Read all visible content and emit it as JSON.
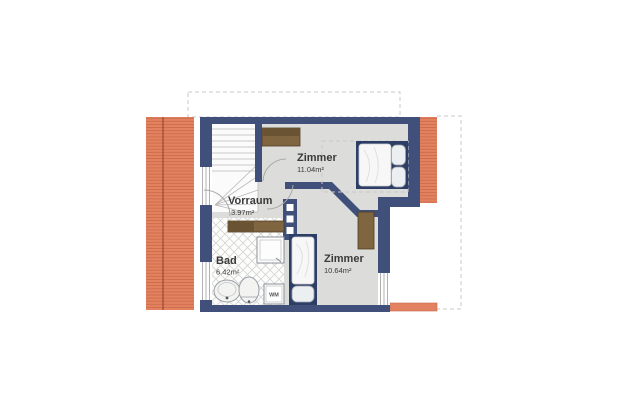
{
  "floorplan": {
    "rooms": [
      {
        "name": "Zimmer",
        "area": "11.04m²"
      },
      {
        "name": "Vorraum",
        "area": "3.97m²"
      },
      {
        "name": "Bad",
        "area": "6.42m²"
      },
      {
        "name": "Zimmer",
        "area": "10.64m²"
      }
    ],
    "appliances": [
      {
        "label": "WM",
        "type": "washing-machine"
      }
    ],
    "colors": {
      "wall": "#41507a",
      "roof": "#e28260",
      "roof_line": "#c96847",
      "roof_ridge": "#a04a34",
      "floor": "#dcdcda",
      "furniture_brown": "#7f6540",
      "furniture_brown_dark": "#6a5333",
      "bed_frame": "#2c3e66",
      "dashed_outline": "#c9c9c9",
      "text": "#3a3a3a"
    }
  }
}
